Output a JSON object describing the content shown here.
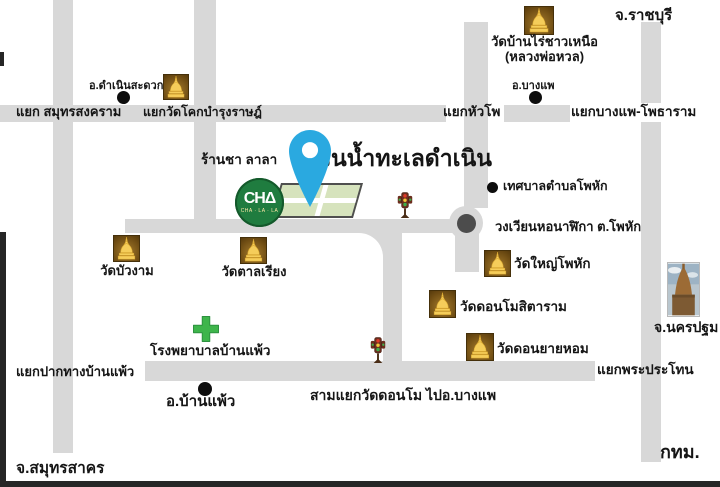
{
  "map": {
    "title": "สวนน้ำทะเลดำเนิน",
    "shop": {
      "name": "ร้านชา ลาลา",
      "logo_text": "CHΔ",
      "logo_subtext": "CHA · LA · LA"
    },
    "provinces": {
      "ratchaburi": "จ.ราชบุรี",
      "nakhon_pathom": "จ.นครปฐม",
      "samut_sakhon": "จ.สมุทรสาคร",
      "bangkok": "กทม."
    },
    "districts": {
      "damnoen_saduak": "อ.ดำเนินสะดวก",
      "bang_phae": "อ.บางแพ",
      "ban_phaeo": "อ.บ้านแพ้ว"
    },
    "junctions": {
      "samut_songkhram": "แยก สมุทรสงคราม",
      "wat_khok_bamrung": "แยกวัดโคกบำรุงราษฎ์",
      "hua_pho": "แยกหัวโพ",
      "bang_phae_photharam": "แยกบางแพ-โพธาราม",
      "pak_thang_ban_phaeo": "แยกปากทางบ้านแพ้ว",
      "phra_prathon": "แยกพระประโทน",
      "sam_yaek_wat_donmo": "สามแยกวัดดอนโม ไปอ.บางแพ"
    },
    "temples": {
      "wat_banrai_line1": "วัดบ้านไร่ชาวเหนือ",
      "wat_banrai_line2": "(หลวงพ่อหวล)",
      "wat_buangam": "วัดบัวงาม",
      "wat_tanriang": "วัดตาลเรียง",
      "wat_yai_phohak": "วัดใหญ่โพหัก",
      "wat_donmo_sitaram": "วัดดอนโมสิตาราม",
      "wat_don_yai_hom": "วัดดอนยายหอม"
    },
    "places": {
      "phohak_municipality": "เทศบาลตำบลโพหัก",
      "clock_tower_roundabout": "วงเวียนหอนาฬิกา ต.โพหัก",
      "hospital": "โรงพยาบาลบ้านแพ้ว"
    },
    "colors": {
      "road": "#d8d8d8",
      "pin_blue": "#2aa9e0",
      "logo_green": "#1f7c3f",
      "cross_green": "#3eb54b",
      "temple_brown": "#6e4c13",
      "temple_gold": "#f5cd5a"
    }
  }
}
